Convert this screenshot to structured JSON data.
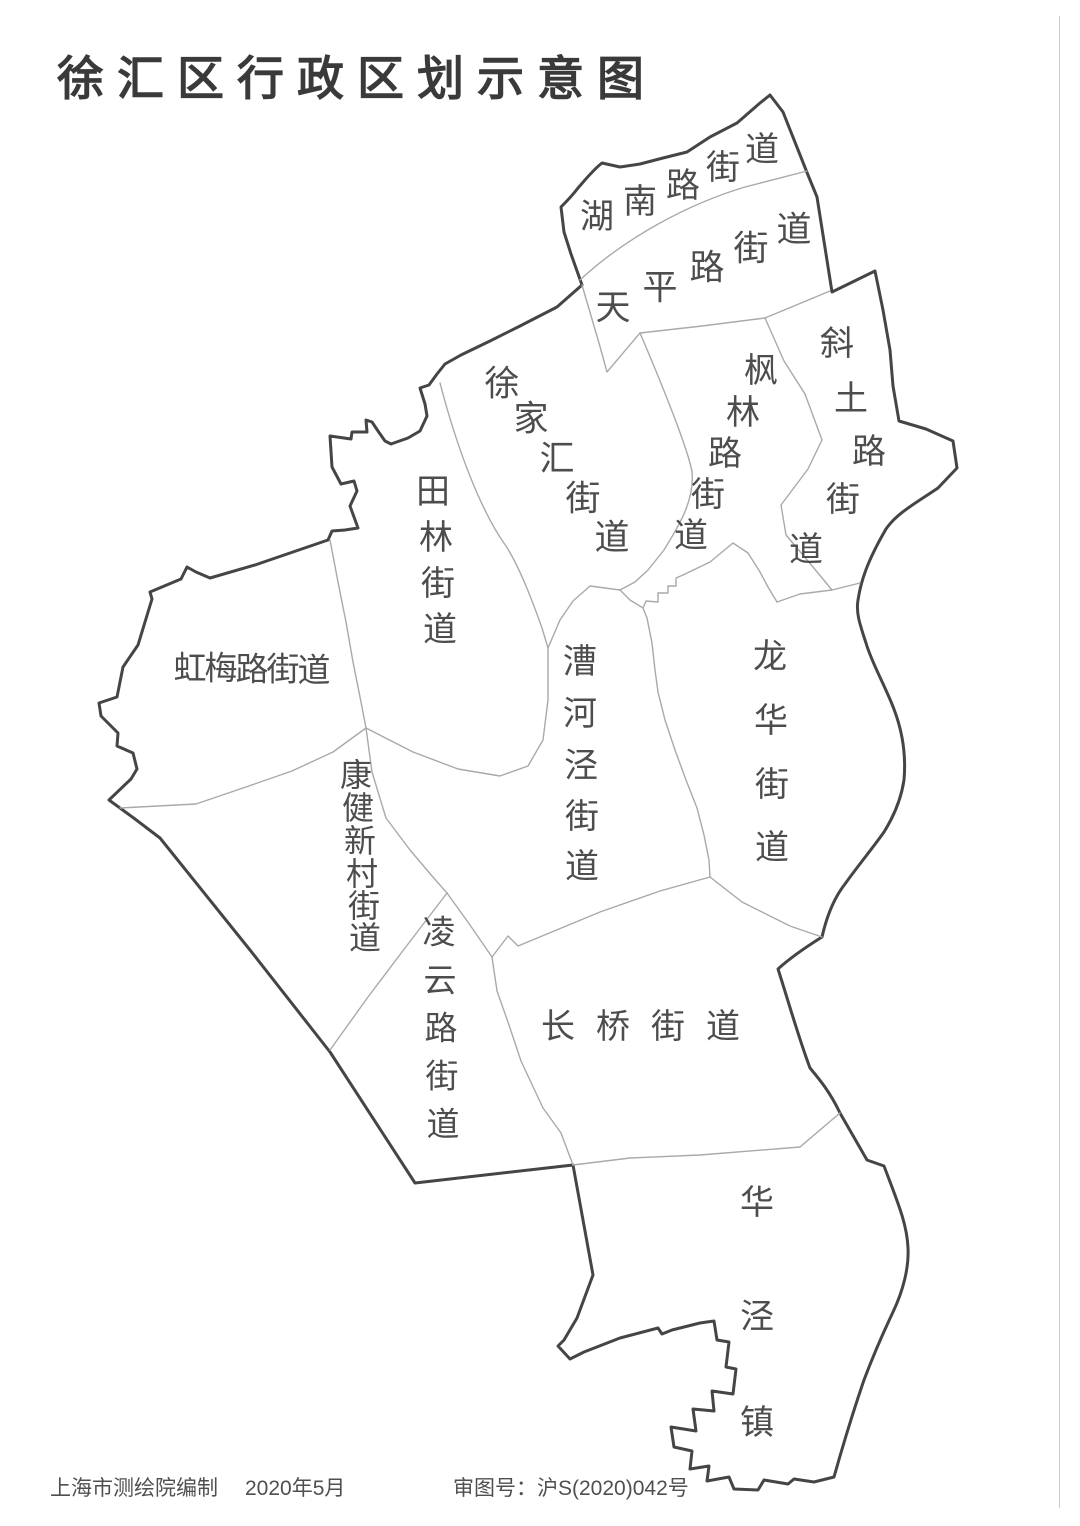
{
  "title": "徐汇区行政区划示意图",
  "footer": {
    "credit": "上海市测绘院编制",
    "date": "2020年5月",
    "approval": "审图号：沪S(2020)042号"
  },
  "map": {
    "district_name": "徐汇区",
    "colors": {
      "outer_boundary": "#454545",
      "inner_boundary": "#a9a9a9",
      "label_text": "#4d4d4d",
      "title_text": "#3a3a3a",
      "background": "#ffffff",
      "neatline": "#cccccc"
    },
    "labels": [
      {
        "name": "hunan-road",
        "text": "湖南路街道",
        "size": 34,
        "chars": [
          [
            597,
            217
          ],
          [
            640,
            202
          ],
          [
            683,
            186
          ],
          [
            723,
            168
          ],
          [
            762,
            150
          ]
        ]
      },
      {
        "name": "tianping-road",
        "text": "天平路街道",
        "size": 35,
        "chars": [
          [
            613,
            308
          ],
          [
            660,
            288
          ],
          [
            707,
            268
          ],
          [
            751,
            249
          ],
          [
            794,
            230
          ]
        ]
      },
      {
        "name": "xujiahui",
        "text": "徐家汇街道",
        "size": 35,
        "chars": [
          [
            502,
            384
          ],
          [
            531,
            419
          ],
          [
            557,
            459
          ],
          [
            583,
            499
          ],
          [
            612,
            538
          ]
        ]
      },
      {
        "name": "fenglin-road",
        "text": "枫林路街道",
        "size": 34,
        "chars": [
          [
            761,
            371
          ],
          [
            743,
            413
          ],
          [
            725,
            454
          ],
          [
            708,
            495
          ],
          [
            691,
            536
          ]
        ]
      },
      {
        "name": "xietu-road",
        "text": "斜土路街道",
        "size": 34,
        "chars": [
          [
            837,
            344
          ],
          [
            851,
            399
          ],
          [
            869,
            452
          ],
          [
            843,
            500
          ],
          [
            806,
            550
          ]
        ]
      },
      {
        "name": "tianlin",
        "text": "田林街道",
        "size": 34,
        "chars": [
          [
            433,
            492
          ],
          [
            436,
            538
          ],
          [
            438,
            584
          ],
          [
            440,
            630
          ]
        ]
      },
      {
        "name": "hongmei-road",
        "text": "虹梅路街道",
        "size": 33,
        "chars": [
          [
            190,
            668
          ],
          [
            221,
            668
          ],
          [
            252,
            669
          ],
          [
            283,
            669
          ],
          [
            314,
            670
          ]
        ]
      },
      {
        "name": "caohejing",
        "text": "漕河泾街道",
        "size": 34,
        "chars": [
          [
            580,
            662
          ],
          [
            580,
            714
          ],
          [
            581,
            766
          ],
          [
            582,
            817
          ],
          [
            582,
            867
          ]
        ]
      },
      {
        "name": "longhua",
        "text": "龙华街道",
        "size": 34,
        "chars": [
          [
            770,
            657
          ],
          [
            771,
            721
          ],
          [
            772,
            785
          ],
          [
            772,
            848
          ]
        ]
      },
      {
        "name": "kangjian-xincun",
        "text": "康健新村街道",
        "size": 32,
        "chars": [
          [
            356,
            775
          ],
          [
            358,
            808
          ],
          [
            360,
            841
          ],
          [
            362,
            874
          ],
          [
            364,
            906
          ],
          [
            365,
            938
          ]
        ]
      },
      {
        "name": "lingyun-road",
        "text": "凌云路街道",
        "size": 33,
        "chars": [
          [
            439,
            932
          ],
          [
            440,
            980
          ],
          [
            441,
            1028
          ],
          [
            442,
            1076
          ],
          [
            443,
            1124
          ]
        ]
      },
      {
        "name": "changqiao",
        "text": "长桥街道",
        "size": 34,
        "chars": [
          [
            558,
            1027
          ],
          [
            613,
            1027
          ],
          [
            668,
            1027
          ],
          [
            723,
            1027
          ]
        ]
      },
      {
        "name": "huajing-town",
        "text": "华泾镇",
        "size": 34,
        "chars": [
          [
            757,
            1203
          ],
          [
            757,
            1317
          ],
          [
            757,
            1423
          ]
        ]
      }
    ]
  }
}
